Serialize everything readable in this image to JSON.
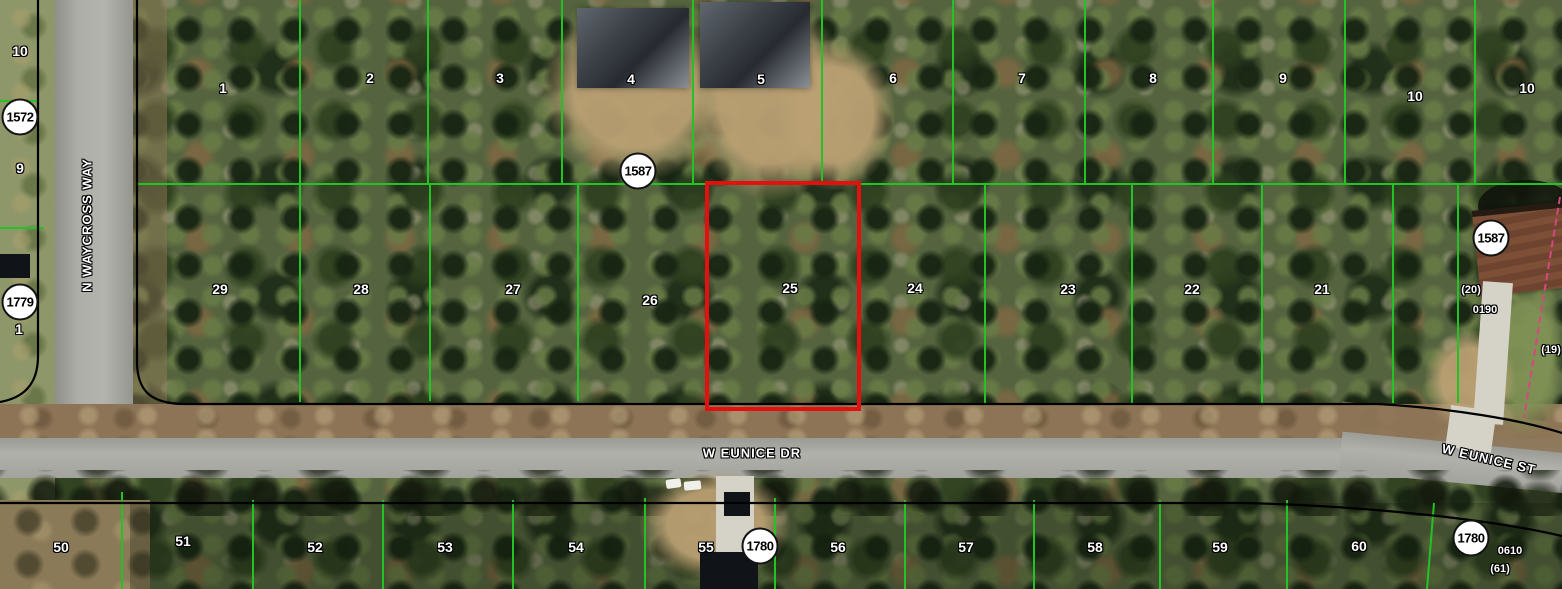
{
  "map": {
    "type": "aerial-parcel-map",
    "selected_parcel": {
      "lot": "25",
      "outline_color": "#e31010"
    },
    "streets": [
      {
        "name": "N WAYCROSS WAY",
        "x": 87,
        "y": 225,
        "rot": -90
      },
      {
        "name": "W EUNICE DR",
        "x": 752,
        "y": 453,
        "rot": 0
      },
      {
        "name": "W EUNICE ST",
        "x": 1489,
        "y": 459,
        "rot": 13
      }
    ],
    "block_circles": [
      {
        "label": "1572",
        "x": 20,
        "y": 117
      },
      {
        "label": "1779",
        "x": 20,
        "y": 302
      },
      {
        "label": "1587",
        "x": 638,
        "y": 171
      },
      {
        "label": "1587",
        "x": 1491,
        "y": 238
      },
      {
        "label": "1780",
        "x": 760,
        "y": 546
      },
      {
        "label": "1780",
        "x": 1471,
        "y": 538
      }
    ],
    "lot_labels": [
      {
        "label": "10",
        "x": 20,
        "y": 51
      },
      {
        "label": "9",
        "x": 20,
        "y": 168
      },
      {
        "label": "1",
        "x": 19,
        "y": 329
      },
      {
        "label": "1",
        "x": 223,
        "y": 88
      },
      {
        "label": "2",
        "x": 370,
        "y": 78
      },
      {
        "label": "3",
        "x": 500,
        "y": 78
      },
      {
        "label": "4",
        "x": 631,
        "y": 79
      },
      {
        "label": "5",
        "x": 761,
        "y": 79
      },
      {
        "label": "6",
        "x": 893,
        "y": 78
      },
      {
        "label": "7",
        "x": 1022,
        "y": 78
      },
      {
        "label": "8",
        "x": 1153,
        "y": 78
      },
      {
        "label": "9",
        "x": 1283,
        "y": 78
      },
      {
        "label": "10",
        "x": 1415,
        "y": 96
      },
      {
        "label": "10",
        "x": 1527,
        "y": 88
      },
      {
        "label": "29",
        "x": 220,
        "y": 289
      },
      {
        "label": "28",
        "x": 361,
        "y": 289
      },
      {
        "label": "27",
        "x": 513,
        "y": 289
      },
      {
        "label": "26",
        "x": 650,
        "y": 300
      },
      {
        "label": "25",
        "x": 790,
        "y": 288
      },
      {
        "label": "24",
        "x": 915,
        "y": 288
      },
      {
        "label": "23",
        "x": 1068,
        "y": 289
      },
      {
        "label": "22",
        "x": 1192,
        "y": 289
      },
      {
        "label": "21",
        "x": 1322,
        "y": 289
      },
      {
        "label": "50",
        "x": 61,
        "y": 547
      },
      {
        "label": "51",
        "x": 183,
        "y": 541
      },
      {
        "label": "52",
        "x": 315,
        "y": 547
      },
      {
        "label": "53",
        "x": 445,
        "y": 547
      },
      {
        "label": "54",
        "x": 576,
        "y": 547
      },
      {
        "label": "55",
        "x": 706,
        "y": 547
      },
      {
        "label": "56",
        "x": 838,
        "y": 547
      },
      {
        "label": "57",
        "x": 966,
        "y": 547
      },
      {
        "label": "58",
        "x": 1095,
        "y": 547
      },
      {
        "label": "59",
        "x": 1220,
        "y": 547
      },
      {
        "label": "60",
        "x": 1359,
        "y": 546
      }
    ],
    "parcel_annotations": [
      {
        "label": "(20)",
        "x": 1471,
        "y": 290
      },
      {
        "label": "0190",
        "x": 1485,
        "y": 310
      },
      {
        "label": "(19)",
        "x": 1551,
        "y": 350
      },
      {
        "label": "0610",
        "x": 1510,
        "y": 551
      },
      {
        "label": "(61)",
        "x": 1500,
        "y": 569
      }
    ],
    "colors": {
      "parcel_line": "#25c225",
      "road_edge_line": "#000000",
      "highlight": "#e31010",
      "survey_line": "#d6487e",
      "block_circle_fill": "#ffffff"
    }
  }
}
